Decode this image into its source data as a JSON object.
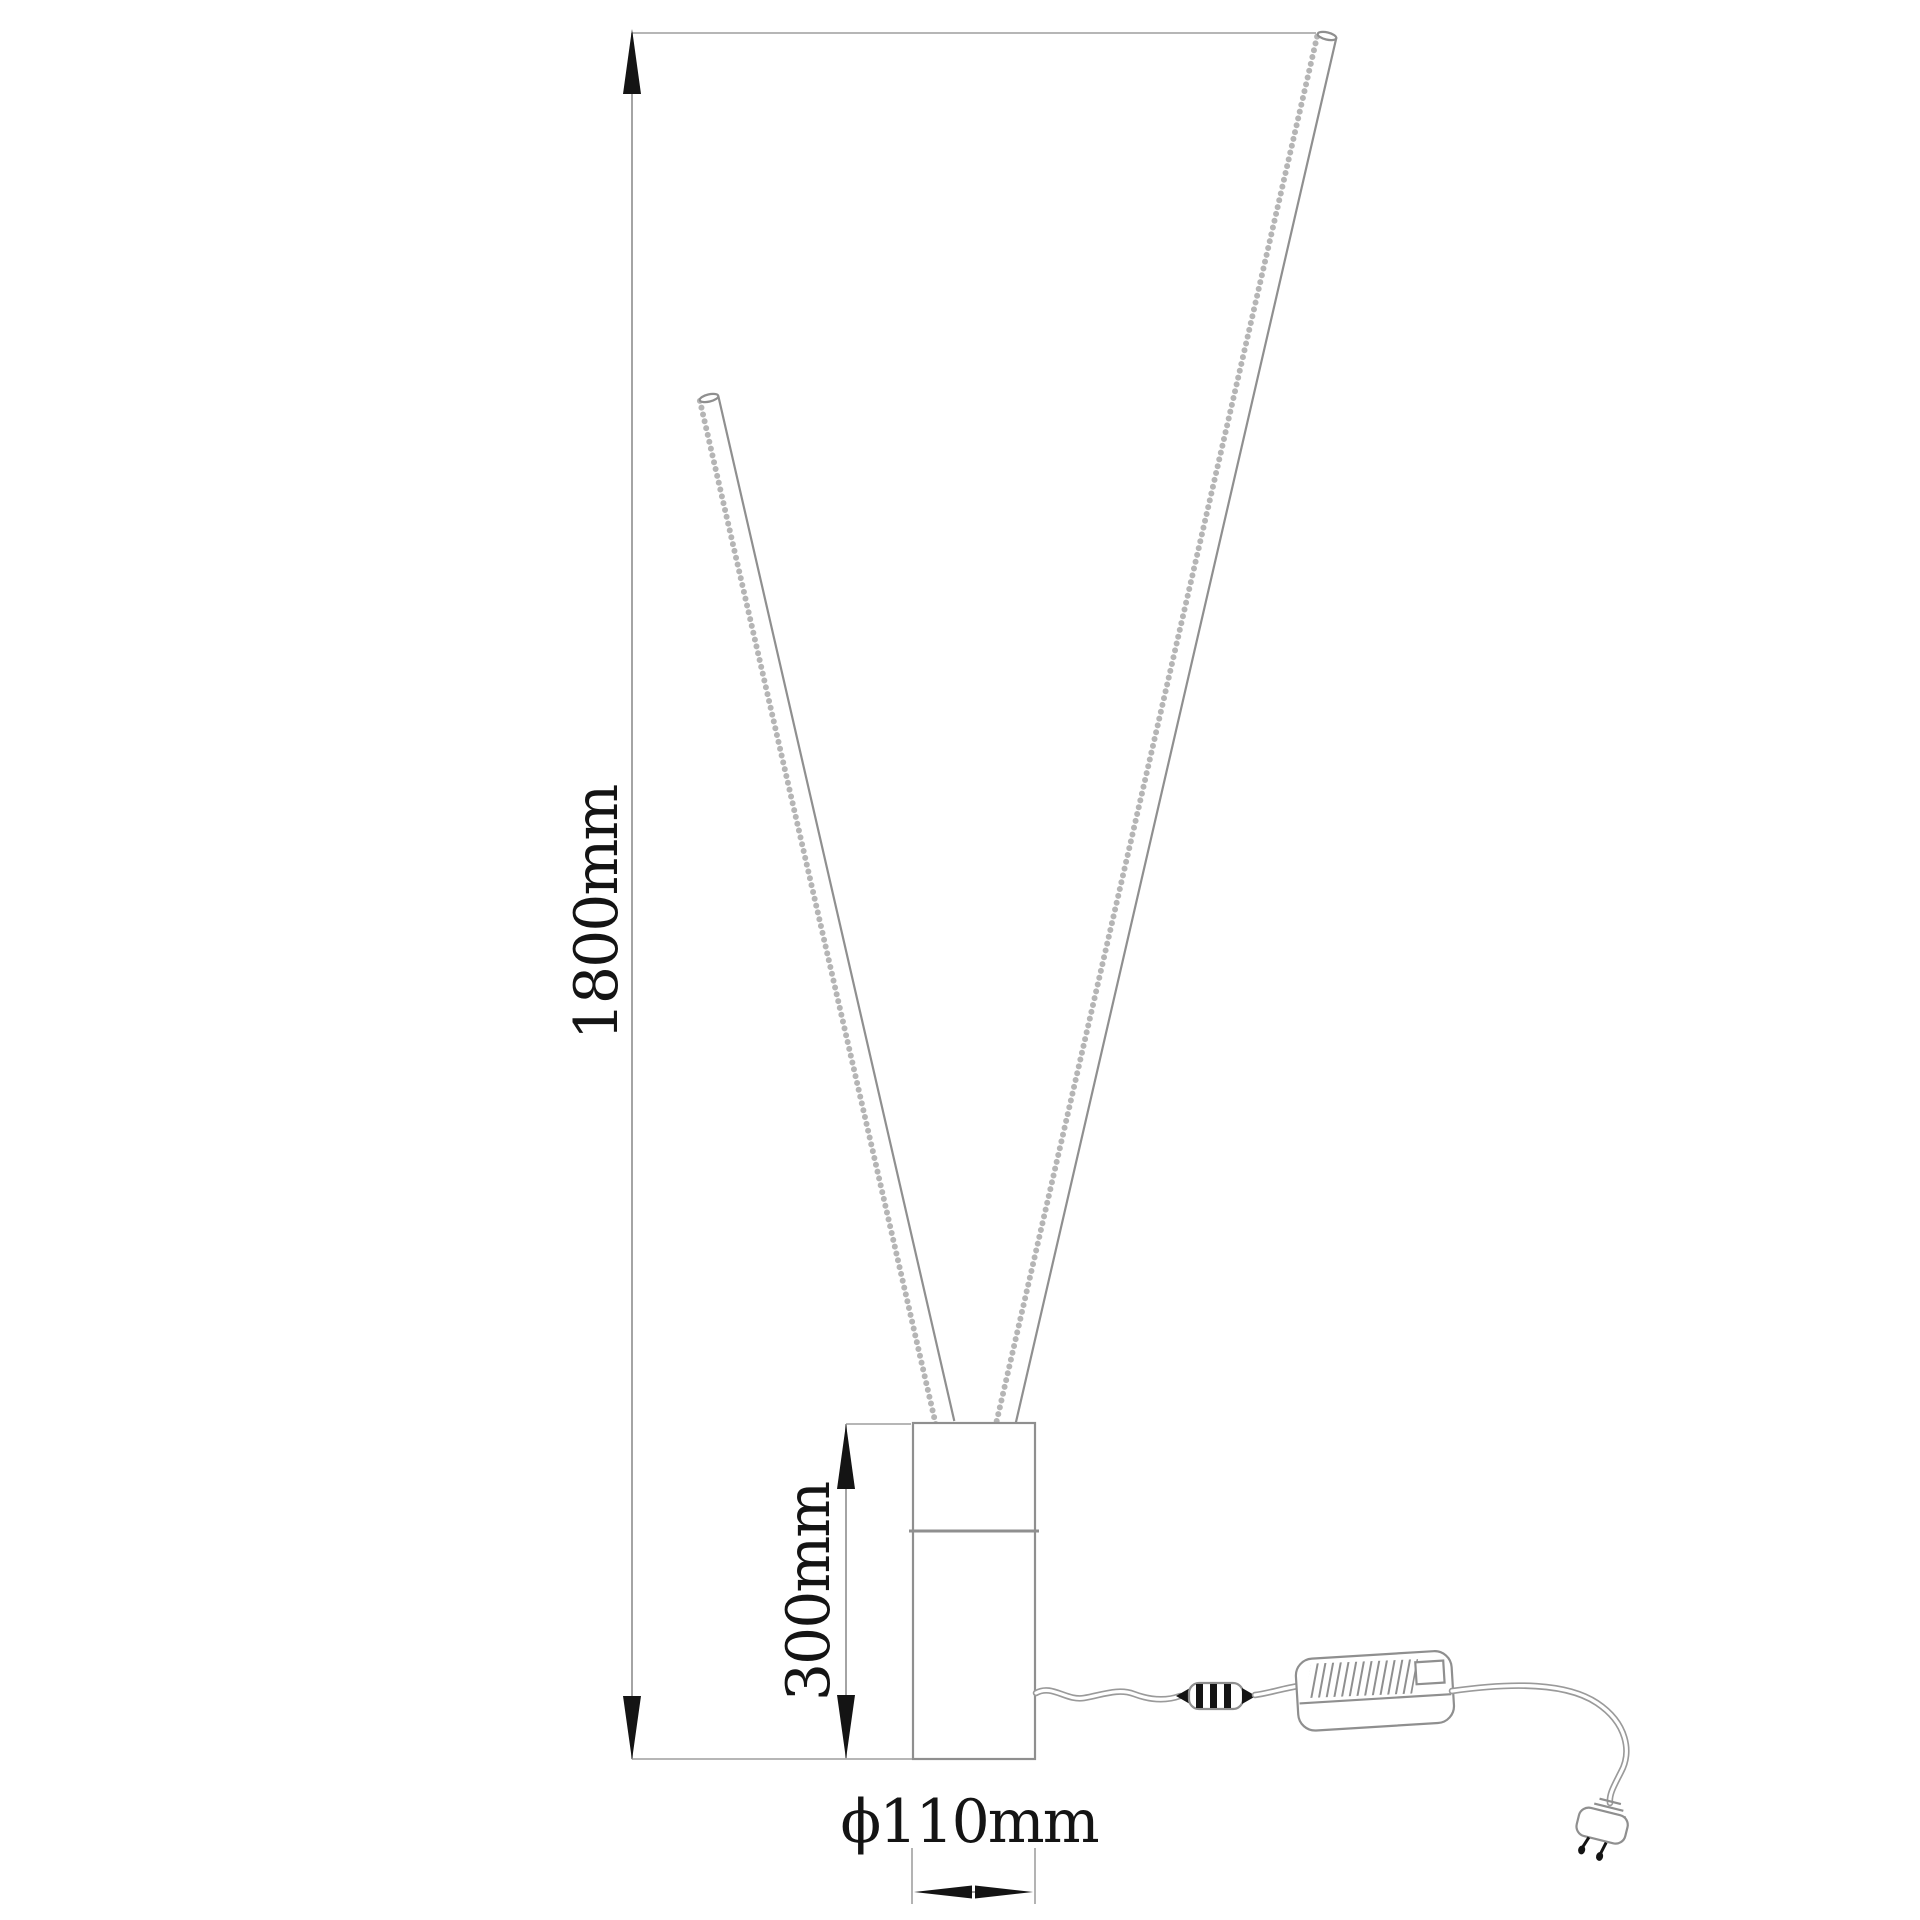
{
  "drawing": {
    "type": "technical-dimension-drawing",
    "subject": "LED floor lamp: two slim light rods in a V shape on a cylindrical base, with power cord, inline connector, driver box and wall plug",
    "labels": {
      "overall_height": "1800mm",
      "base_height": "300mm",
      "base_diameter": "ϕ110mm"
    },
    "colors": {
      "background": "#ffffff",
      "geometry_line": "#8f8f8f",
      "extension_line": "#ababab",
      "dimension_line": "#9a9a9a",
      "ink": "#141414"
    }
  }
}
